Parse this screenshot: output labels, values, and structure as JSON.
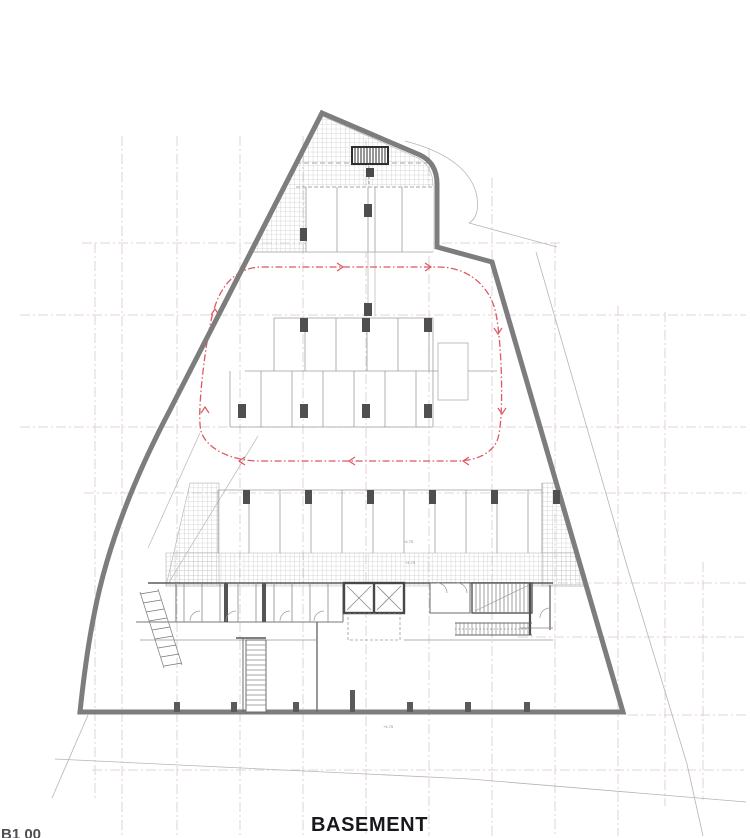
{
  "sheet": {
    "title": "BASEMENT",
    "code": "B1 00"
  },
  "annotations": {
    "level_marks": [
      {
        "text": "+4.75"
      },
      {
        "text": "+4.75"
      },
      {
        "text": "+4.75"
      }
    ]
  },
  "colors": {
    "wall": "#7d7d7d",
    "grid": "#d9c7cd",
    "circulation": "#de5864",
    "hatch": "#c7c7c7",
    "dark_structure": "#4f4f4f"
  }
}
